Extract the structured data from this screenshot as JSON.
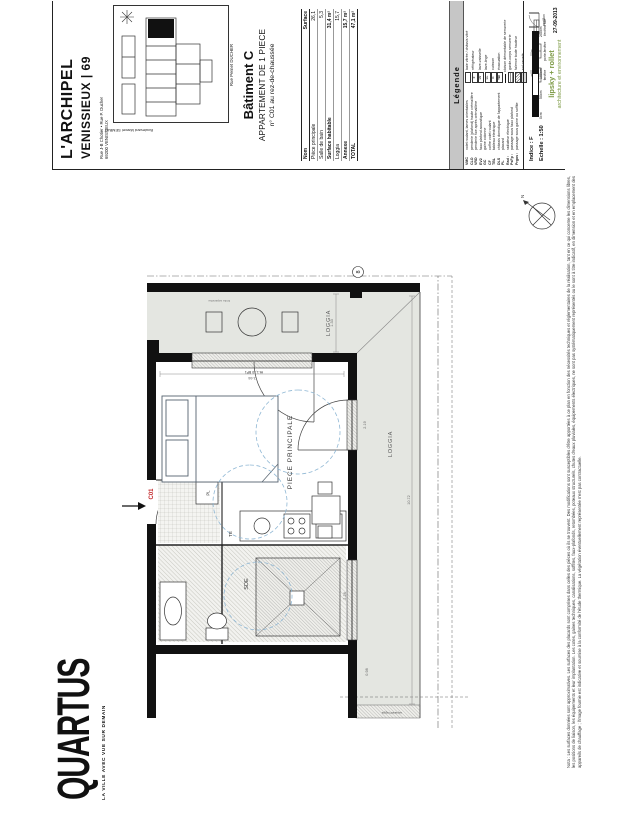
{
  "sheet": {
    "project_title": "L'ARCHIPEL",
    "project_subtitle": "VENISSIEUX | 69",
    "address_line1": "Rue J-B Chotier • Rue P. Ducher",
    "address_line2": "69200 VENISSIEUX",
    "site_caption": "Rue Pernet DUCHER",
    "site_side_label": "Boulevard Marcel SEMBAT",
    "building": "Bâtiment C",
    "apartment_type": "APPARTEMENT DE 1 PIECE",
    "apartment_number": "n° C01 au rez-de-chaussée"
  },
  "surface_table": {
    "headers": [
      "Nom",
      "Surface"
    ],
    "rows": [
      {
        "name": "Pièce principale",
        "value": "26,1"
      },
      {
        "name": "Salle de bain",
        "value": "5,3"
      },
      {
        "name": "Surface habitable",
        "value": "31,4 m²"
      },
      {
        "name": "Loggia",
        "value": "15,7"
      },
      {
        "name": "Annexe",
        "value": "15,7 m²"
      },
      {
        "name": "TOTAL",
        "value": "47,1 m²"
      }
    ]
  },
  "legend": {
    "title": "Légende",
    "abbrev_items": [
      {
        "abbr": "VMC",
        "label": "volet roulant, lames orientables"
      },
      {
        "abbr": "CLO",
        "label": "penderie (plafond) haute crémaillère"
      },
      {
        "abbr": "VRD",
        "label": "penderie fixe après crémaillère"
      },
      {
        "abbr": "EV2",
        "label": "faux plafond acoustique"
      },
      {
        "abbr": "GC",
        "label": "gaine colonne"
      },
      {
        "abbr": "CF",
        "label": "coffre volet roulant"
      },
      {
        "abbr": "TBL",
        "label": "tableau électrique"
      },
      {
        "abbr": "DLS",
        "label": "châssis domotique de l'appartement"
      },
      {
        "abbr": "PL",
        "label": "placard"
      },
      {
        "abbr": "Rad :",
        "label": "radiateur électrique"
      },
      {
        "abbr": "PsFp :",
        "label": "passage sous faux plafond"
      },
      {
        "abbr": "Prgos :",
        "label": "passage sous gaine ou soffite"
      }
    ],
    "icon_items": [
      {
        "t": "",
        "label": "baie vitrée / châssis vitré"
      },
      {
        "t": "F",
        "label": "réfrigérateur"
      },
      {
        "t": "LV",
        "label": "lave-vaisselle"
      },
      {
        "t": "LL",
        "label": "lave-linge"
      },
      {
        "t": "C",
        "label": "cuisson"
      },
      {
        "t": "TBl",
        "label": "évacuation"
      },
      {
        "t": "",
        "label": "cloison démontable de serrurerie"
      },
      {
        "t": "",
        "label": "garde-corps serrurerie"
      },
      {
        "t": "",
        "label": "faïence toute hauteur"
      },
      {
        "t": "",
        "label": "sol carrelé"
      }
    ],
    "opening_icons": [
      "fenêtre",
      "porte-fenêtre",
      "fenêtre fixe"
    ],
    "portillon_label": "portillon"
  },
  "titleblock": {
    "indice": "Indice : F",
    "echelle": "Echelle : 1:50",
    "scale_ticks": [
      "0cm",
      "50cm",
      "100cm",
      "200cm"
    ],
    "date": "27-09-2013",
    "architect_line1": "lipsky + rollet",
    "architect_line2": "architecture et environnement"
  },
  "brand": {
    "name": "QUARTUS",
    "tagline": "LA VILLE AVEC VUE SUR DEMAIN"
  },
  "plan": {
    "room_main": "PIECE PRINCIPALE",
    "loggia_label": "LOGGIA",
    "sde_label": "SDE",
    "te_label": "TE",
    "pl_label": "PL",
    "entry_label": "C01",
    "grid_marker": "8",
    "north_label": "N",
    "window_label": "Ht.1,10 BP1",
    "separatif_label": "séparatif loggia",
    "limite_label": "limite séparative",
    "dims": {
      "d133": "1.33",
      "d1072": "10.72",
      "d098": "0.98",
      "d366": "3.66",
      "d228": "2.28",
      "d219": "2.19"
    }
  },
  "nota": "Nota : Les surfaces données sont approximatives. Les surfaces des placards sont comprises dans celles des pièces où ils se trouvent. Des modifications sont susceptibles d'être apportées à ce plan en fonction des nécessités techniques et réglementaires de la réalisation, tant en ce qui concerne les dimensions libres, les positions de liaison, les équipements et leur implantation. Les cotes, gaines techniques, canalisations, soffites, faux-plafonds, retombées, poteaux structurels, chutes d'eaux pluviales, équipements électriques, ne sont pas systématiquement représentés ou le sont à titre indicatif, en dimension et en emplacement des appareils de chauffage ; l'image fournie est indicative et soumise à la conformité de l'étude thermique. La végétation éventuellement représentée n'est pas contractuelle."
}
